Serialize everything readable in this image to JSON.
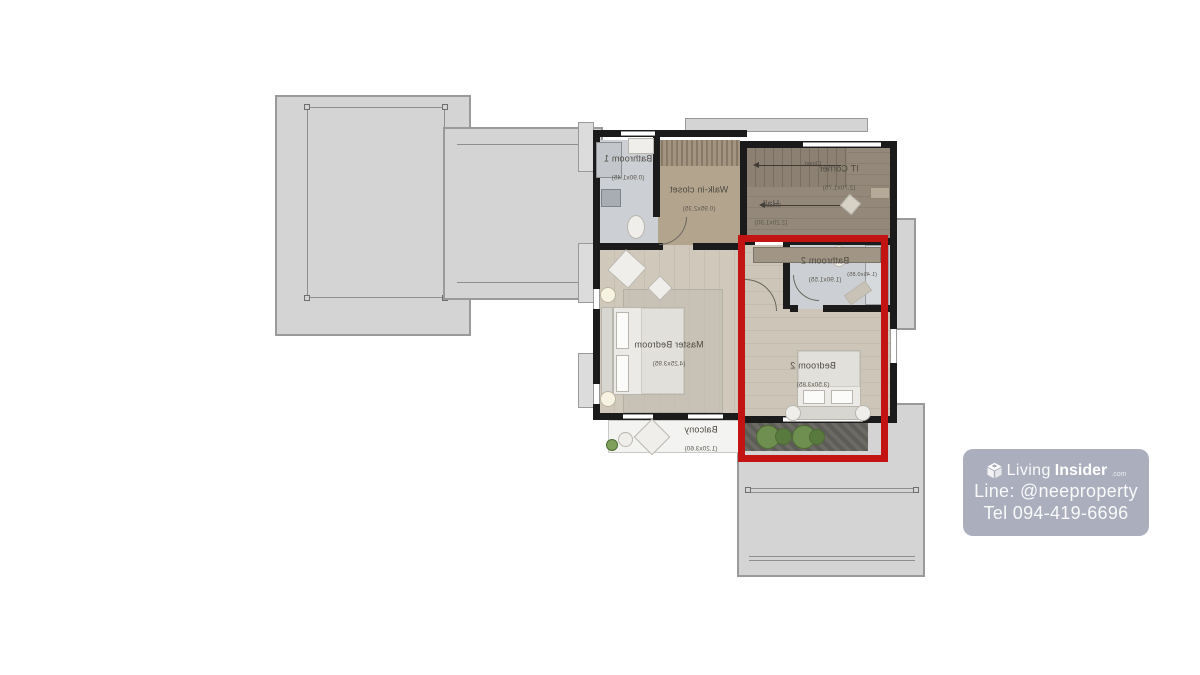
{
  "meta": {
    "type": "second-floor plan, mirrored rendering",
    "highlight_color": "#c31414"
  },
  "floorplan": {
    "rooms": [
      {
        "name": "Bathroom 1",
        "dims": "(0.90x1.45)"
      },
      {
        "name": "Walk-in closet",
        "dims": "(0.95x2.35)"
      },
      {
        "name": "IT Corner",
        "dims": "(2.70x1.75)"
      },
      {
        "name": "Hall",
        "dims": "(2.20x1.30)"
      },
      {
        "name": "Bathroom 2",
        "dims": "(1.90x1.55)"
      },
      {
        "name": "Master Bedroom",
        "dims": "(4.25x3.95)"
      },
      {
        "name": "Bedroom 2",
        "dims": "(3.50x3.85)"
      },
      {
        "name": "Balcony",
        "dims": "(1.20x3.60)"
      }
    ],
    "annotations": [
      {
        "text": "Closet"
      },
      {
        "text": "Closet"
      },
      {
        "text": "(1.45x0.85)"
      }
    ]
  },
  "watermark": {
    "brand": {
      "word1": "Living",
      "word2": "Insider",
      "suffix": ".com"
    },
    "line_contact": "Line: @neeproperty",
    "phone": "Tel 094-419-6696",
    "bg_color": "#a5a8b7"
  }
}
